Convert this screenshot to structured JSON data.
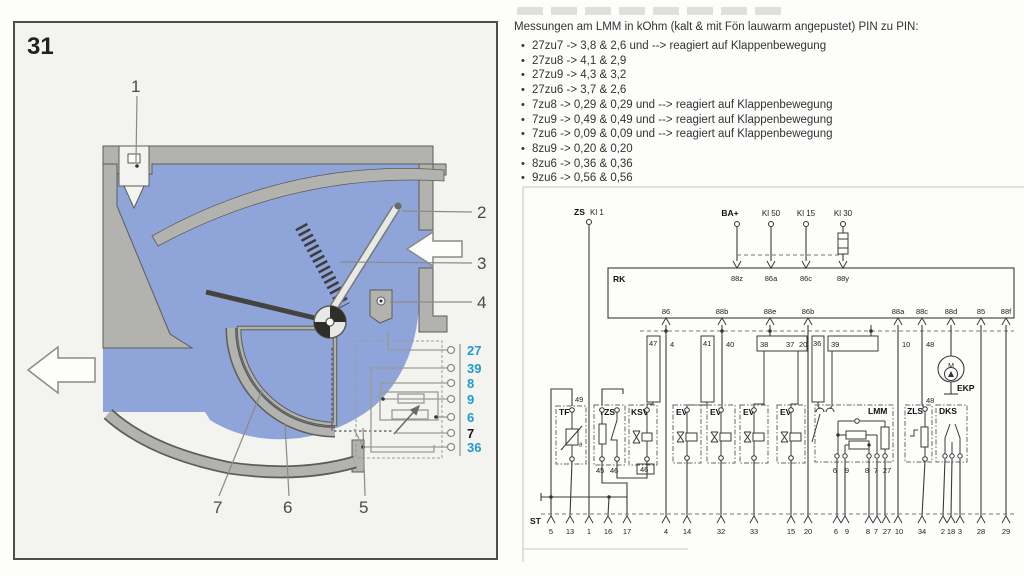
{
  "measurements": {
    "title": "Messungen am LMM in kOhm (kalt & mit Fön lauwarm angepustet) PIN zu PIN:",
    "items": [
      "27zu7 -> 3,8 & 2,6 und --> reagiert auf Klappenbewegung",
      "27zu8 -> 4,1 & 2,9",
      "27zu9 -> 4,3 & 3,2",
      "27zu6 -> 3,7 & 2,6",
      "7zu8 -> 0,29 & 0,29 und --> reagiert auf Klappenbewegung",
      "7zu9 -> 0,49 & 0,49 und --> reagiert auf Klappenbewegung",
      "7zu6 -> 0,09 & 0,09 und --> reagiert auf Klappenbewegung",
      "8zu9 -> 0,20 & 0,20",
      "8zu6 -> 0,36 & 0,36",
      "9zu6 -> 0,56 & 0,56"
    ]
  },
  "figure": {
    "number": "31",
    "callouts": [
      "1",
      "2",
      "3",
      "4",
      "5",
      "6",
      "7"
    ],
    "pins": [
      {
        "label": "27",
        "color": "#1f9ccd"
      },
      {
        "label": "39",
        "color": "#1f9ccd"
      },
      {
        "label": "8",
        "color": "#1f9ccd"
      },
      {
        "label": "9",
        "color": "#1f9ccd"
      },
      {
        "label": "6",
        "color": "#1f9ccd"
      },
      {
        "label": "7",
        "color": "#1a1a1a"
      },
      {
        "label": "36",
        "color": "#1f9ccd"
      }
    ],
    "colors": {
      "interior": "#8fa5da",
      "housing": "#b2b2ae",
      "outline": "#5d5d57"
    }
  },
  "schematic": {
    "supply": {
      "zs_bold": "ZS",
      "zs_rest": "Kl 1",
      "ba": "BA+",
      "kl50": "Kl 50",
      "kl15": "Kl 15",
      "kl30": "Kl 30"
    },
    "rk": {
      "label": "RK",
      "top_pins": [
        "88z",
        "86a",
        "86c",
        "88y"
      ],
      "bottom_pins": [
        "86",
        "88b",
        "88e",
        "86b",
        "88a",
        "88c",
        "88d",
        "85",
        "88f"
      ]
    },
    "wires": {
      "w47": "47",
      "w4": "4",
      "w41": "41",
      "w40": "40",
      "w38": "38",
      "w37": "37",
      "w20": "20",
      "w36": "36",
      "w39": "39",
      "w10": "10",
      "w48": "48",
      "w48b": "48",
      "w49": "49"
    },
    "components": {
      "tf": {
        "label": "TF",
        "bottom": "13",
        "theta": "ϑ"
      },
      "tzs": {
        "label": "TZS",
        "pin45": "45",
        "pin46": "46"
      },
      "ksv": {
        "label": "KSV",
        "pin46": "46"
      },
      "ev": {
        "label": "EV"
      },
      "lmm": {
        "label": "LMM",
        "p6": "6",
        "p9": "9",
        "p8": "8",
        "p7": "7",
        "p27": "27"
      },
      "zls": {
        "label": "ZLS"
      },
      "dks": {
        "label": "DKS"
      },
      "ekp": {
        "label": "EKP",
        "motor": "M"
      }
    },
    "st_label": "ST",
    "bottom_terminals": [
      "5",
      "13",
      "1",
      "16",
      "17",
      "4",
      "14",
      "32",
      "33",
      "15",
      "20",
      "6",
      "9",
      "8",
      "7",
      "27",
      "10",
      "34",
      "2",
      "18",
      "3",
      "28",
      "29"
    ]
  }
}
